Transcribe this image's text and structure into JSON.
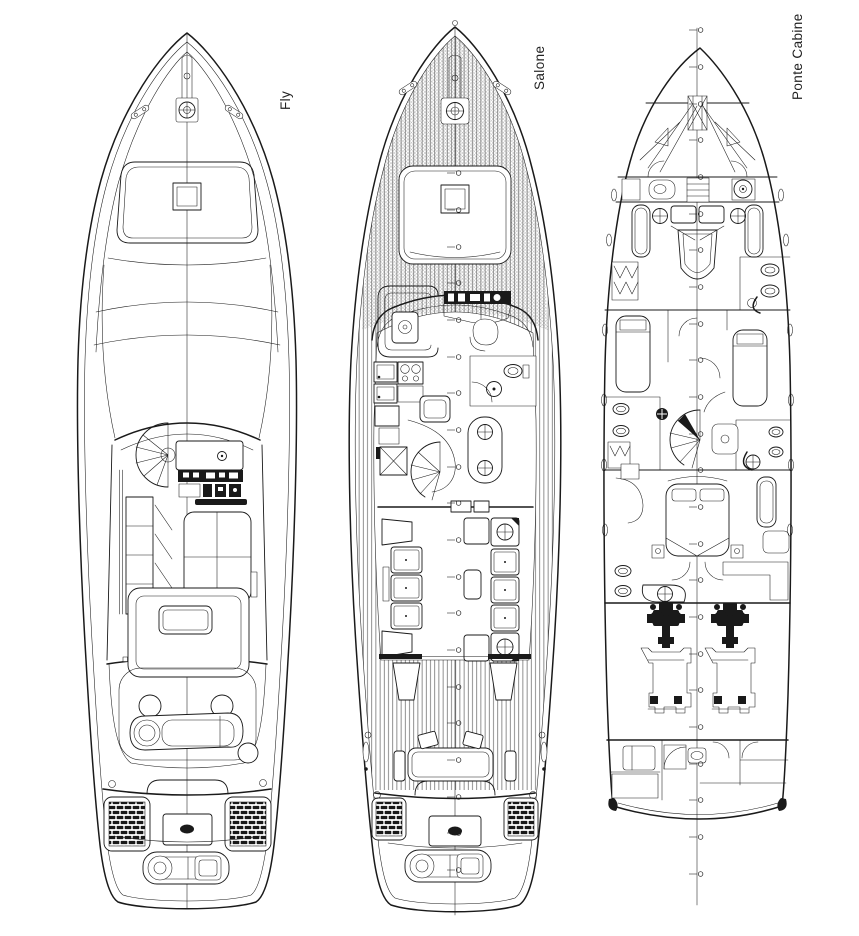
{
  "sheet": {
    "background": "#ffffff",
    "ink": "#1a1a1a",
    "deck_hatch_color": "#8a8a8a",
    "teak_stripe_color": "#5f5f5f"
  },
  "plans": [
    {
      "id": "fly",
      "label": "Fly"
    },
    {
      "id": "salone",
      "label": "Salone"
    },
    {
      "id": "ponte-cabine",
      "label": "Ponte Cabine"
    }
  ]
}
